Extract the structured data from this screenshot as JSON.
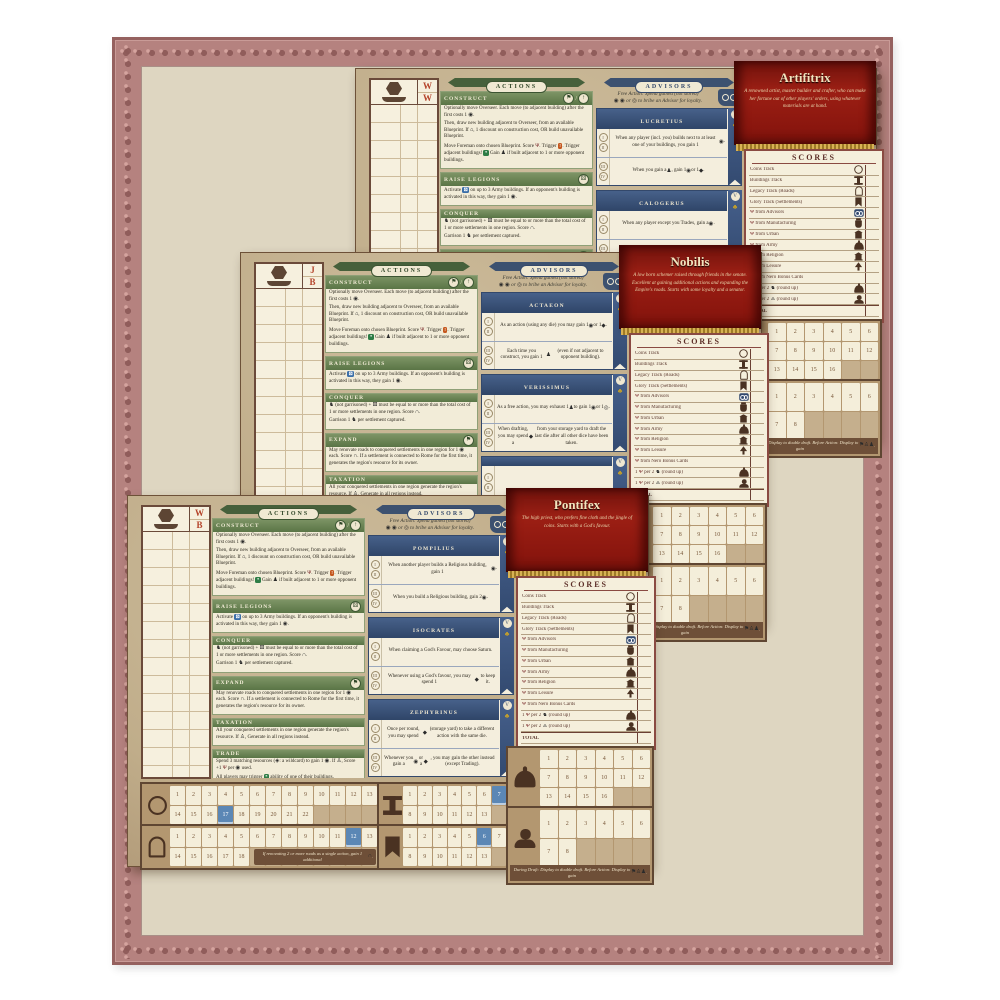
{
  "frame": {
    "band_color": "#b5827f",
    "edge_color": "#95615f",
    "mat_color": "#ded6c1"
  },
  "tokens": {
    "coin": {
      "g": "◉"
    },
    "coinw": {
      "g": "◎"
    },
    "res": {
      "g": "◆"
    },
    "meeple": {
      "g": "♟"
    },
    "legion": {
      "g": "♞"
    },
    "trophy": {
      "g": "Ψ",
      "c": "#7a2a2a"
    },
    "road": {
      "g": "∩"
    },
    "die": {
      "g": "⚄"
    },
    "dieblue": {
      "g": "⚄",
      "bg": "#3a6ea8",
      "c": "#ffffff"
    },
    "gear": {
      "g": "*",
      "bg": "#2e7d46",
      "c": "#ffffff"
    },
    "tile": {
      "g": "!",
      "bg": "#c5571d",
      "c": "#ffffff"
    },
    "dome": {
      "g": "⌂"
    },
    "senator": {
      "g": "♙"
    },
    "wild": {
      "g": "◈"
    },
    "hammer": {
      "g": "⚒"
    },
    "blue": {
      "t": "BLUE",
      "bg": "#3a6ea8",
      "c": "#ffffff"
    },
    "flag": {
      "g": "⚑"
    },
    "arrow": {
      "g": "↑"
    },
    "club": {
      "g": "♣",
      "c": "#c9a227"
    }
  },
  "shared": {
    "actions_title": "ACTIONS",
    "advisors_title": "ADVISORS",
    "advisors_intro_1": "Free Action: Spend gained (not stored)",
    "advisors_intro_2": "{coin} {coin} or {coinw} to bribe an Advisor for loyalty.",
    "levels_top": [
      "I",
      "II"
    ],
    "levels_bottom": [
      "III",
      "IV"
    ],
    "level_max": "V",
    "actions_sections": [
      {
        "title": "CONSTRUCT",
        "badges": [
          "flag",
          "arrow"
        ],
        "body": [
          "Optionally move Overseer. Each move (to adjacent building) after the first costs 1 {coin}.",
          "Then, draw new building adjacent to Overseer, from an available Blueprint. If {dome}, 1 discount on construction cost, OR build unavailable Blueprint.",
          "Move Foreman onto chosen Blueprint. Score {trophy}. Trigger {tile}. Trigger adjacent buildings! {gear} Gain {meeple} if built adjacent to 1 or more opponent buildings."
        ]
      },
      {
        "title": "RAISE LEGIONS",
        "badges": [
          "die"
        ],
        "body": [
          "Activate {dieblue} on up to 3 Army buildings. If an opponent's building is activated in this way, they gain 1 {coin}."
        ]
      },
      {
        "title": "CONQUER",
        "badges": [],
        "body": [
          "{legion} (not garrisoned) + {die} must be equal to or more than the total cost of 1 or more settlements in one region. Score {road}.",
          "Garrison 1 {legion} per settlement captured."
        ]
      },
      {
        "title": "EXPAND",
        "badges": [
          "flag"
        ],
        "body": [
          "May renovate roads to conquered settlements in one region for 1 {coin} each. Score {road}. If a settlement is connected to Rome for the first time, it generates the region's resource for its owner."
        ]
      },
      {
        "title": "TAXATION",
        "badges": [],
        "body": [
          "All your conquered settlements in one region generate the region's resource. If {senator}, Generate in all regions instead."
        ]
      },
      {
        "title": "TRADE",
        "badges": [],
        "body": [
          "Spend 3 matching resources ({wild}: a wildcard) to gain 1 {coin}. If {senator}, Score +1 {trophy} per {coin} used.",
          "All players may trigger {gear} ability of one of their buildings."
        ]
      }
    ],
    "scores_title": "SCORES",
    "scores_rows": [
      {
        "label": "Coins Track",
        "icon": "coin"
      },
      {
        "label": "Buildings Track",
        "icon": "column"
      },
      {
        "label": "Legacy Track (Roads)",
        "icon": "arch"
      },
      {
        "label": "Glory Track (Settlements)",
        "icon": "banner"
      },
      {
        "label": "{trophy} from Advisors",
        "icon": "owl"
      },
      {
        "label": "{trophy} from Manufacturing",
        "icon": "jar"
      },
      {
        "label": "{trophy} from Urban",
        "icon": "urban"
      },
      {
        "label": "{trophy} from Army",
        "icon": "helm"
      },
      {
        "label": "{trophy} from Religion",
        "icon": "temple"
      },
      {
        "label": "{trophy} from Leisure",
        "icon": "tree"
      },
      {
        "label": "{trophy} from Nero Bonus Cards",
        "icon": ""
      },
      {
        "label": "1 {trophy} per 2 {legion} (round up)",
        "icon": "helm"
      },
      {
        "label": "1 {trophy} per 2 {senator} (round up)",
        "icon": "senatorb"
      },
      {
        "label": "TOTAL",
        "icon": "",
        "total": true
      }
    ],
    "tracks": {
      "coins": {
        "icon": "coin",
        "rows": [
          [
            "1",
            "2",
            "3",
            "4",
            "5",
            "6",
            "7",
            "8",
            "9",
            "10",
            "11",
            "12",
            "13"
          ],
          [
            "14",
            "15",
            "16",
            "17",
            "18",
            "19",
            "20",
            "21",
            "22",
            "",
            "",
            "",
            ""
          ]
        ],
        "highlight": [
          "17"
        ]
      },
      "legacy": {
        "icon": "arch",
        "rows": [
          [
            "1",
            "2",
            "3",
            "4",
            "5",
            "6",
            "7",
            "8",
            "9",
            "10",
            "11",
            "12",
            "13"
          ],
          [
            "14",
            "15",
            "16",
            "17",
            "18",
            "",
            "",
            "",
            "",
            "",
            "",
            "",
            ""
          ]
        ],
        "highlight": [
          "12"
        ],
        "note": "If renovating 2 or more roads as a single action, gain 1 additional {road}."
      },
      "buildings": {
        "icon": "column",
        "rows": [
          [
            "1",
            "2",
            "3",
            "4",
            "5",
            "6",
            "7"
          ],
          [
            "8",
            "9",
            "10",
            "11",
            "12",
            "13",
            ""
          ]
        ],
        "highlight": [
          "7"
        ]
      },
      "glory": {
        "icon": "banner",
        "rows": [
          [
            "1",
            "2",
            "3",
            "4",
            "5",
            "6",
            "7"
          ],
          [
            "8",
            "9",
            "10",
            "11",
            "12",
            "13",
            ""
          ]
        ],
        "highlight": [
          "6"
        ]
      },
      "army": {
        "icon": "helm",
        "rows": [
          [
            "1",
            "2",
            "3",
            "4",
            "5",
            "6"
          ],
          [
            "7",
            "8",
            "9",
            "10",
            "11",
            "12"
          ],
          [
            "13",
            "14",
            "15",
            "16",
            "",
            ""
          ]
        ],
        "highlight": []
      },
      "senators": {
        "icon": "senatorb",
        "rows": [
          [
            "1",
            "2",
            "3",
            "4",
            "5",
            "6"
          ],
          [
            "7",
            "8",
            "",
            "",
            "",
            ""
          ]
        ],
        "highlight": [],
        "note": "During Draft: Display to double draft. Before Action: Display to gain {flag} {senator} {meeple}."
      }
    }
  },
  "boards": {
    "artifitrix": {
      "initials": [
        "W",
        "W"
      ],
      "banner": {
        "name": "Artifitrix",
        "desc": "A renowned artist, master builder and crafter, who can make her fortune out of other players' orders, using whatever materials are at hand."
      },
      "advisors": [
        {
          "name": "LUCRETIUS",
          "top": "When any player (incl. you) builds next to at least one of your buildings, you gain 1 {coin}.",
          "bottom": "When you gain a {meeple}, gain 1 {coin} or 1 {res}."
        },
        {
          "name": "CALOGERUS",
          "top": "When any player except you Trades, gain a {coin}.",
          "bottom": "All faces of the {blue} die gain {hammer}."
        },
        {
          "name": "",
          "top": "",
          "bottom": ""
        }
      ]
    },
    "nobilis": {
      "initials": [
        "J",
        "B"
      ],
      "banner": {
        "name": "Nobilis",
        "desc": "A low born schemer raised through friends in the senate. Excellent at gaining additional actions and expanding the Empire's roads. Starts with some loyalty and a senator."
      },
      "advisors": [
        {
          "name": "ACTAEON",
          "top": "As an action (using any die) you may gain 1 {coin} or 1 {res}.",
          "bottom": "Each time you construct, you gain 1 {meeple} (even if not adjacent to opponent building)."
        },
        {
          "name": "VERISSIMUS",
          "top": "As a free action, you may exhaust 1 {meeple} to gain 1 {coin} or 1 {coinw}.",
          "bottom": "When drafting, you may spend a {res} from your storage yard to draft the last die after all other dice have been taken."
        },
        {
          "name": "",
          "top": "",
          "bottom": ""
        }
      ]
    },
    "pontifex": {
      "initials": [
        "W",
        "B"
      ],
      "banner": {
        "name": "Pontifex",
        "desc": "The high priest, who prefers fine cloth and the jingle of coins. Starts with a God's favour."
      },
      "advisors": [
        {
          "name": "POMPILIUS",
          "top": "When another player builds a Religious building, gain 1 {coin}.",
          "bottom": "When you build a Religious building, gain 2 {coin}."
        },
        {
          "name": "ISOCRATES",
          "top": "When claiming a God's Favour, may choose Saturn.",
          "bottom": "Whenever using a God's favour, you may spend 1 {res} to keep it."
        },
        {
          "name": "ZEPHYRINUS",
          "top": "Once per round, you may spend {res} (storage yard) to take a different action with the same die.",
          "bottom": "Whenever you gain a {coin} or a {res}, you may gain the other instead (except Trading)."
        }
      ]
    }
  }
}
